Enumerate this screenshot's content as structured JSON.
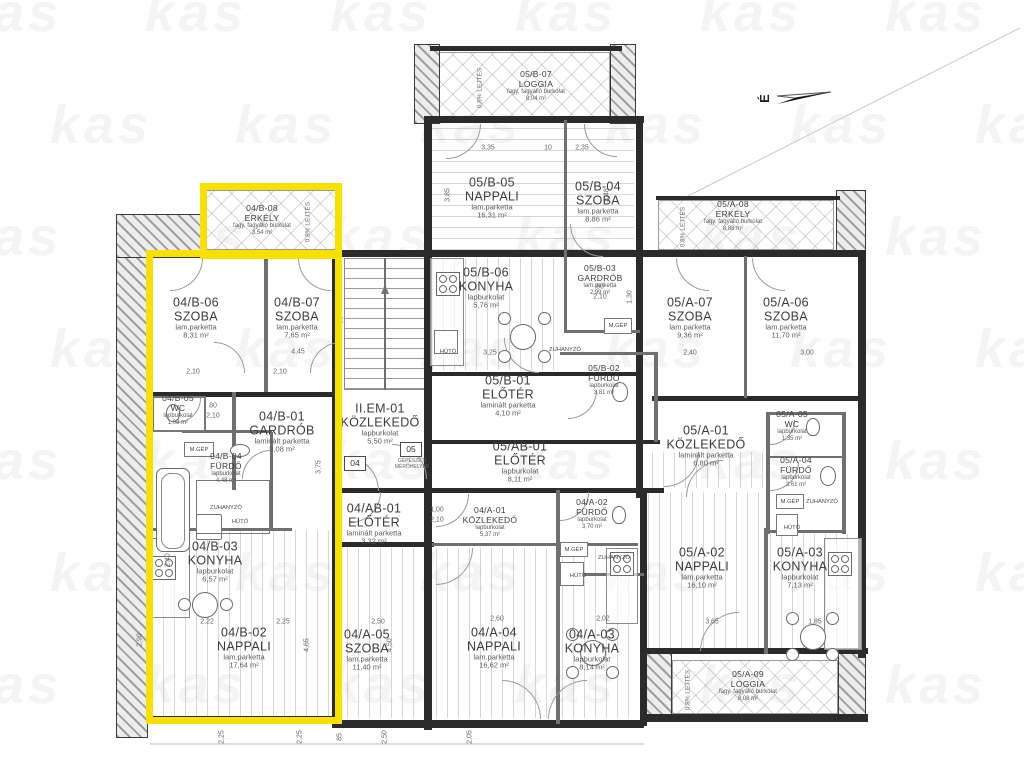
{
  "watermark": {
    "text": "kas"
  },
  "north": {
    "label": "É"
  },
  "markers": {
    "m04": "04",
    "m05": "05"
  },
  "note": {
    "l1": "GÉPÉSZETI",
    "l2": "MÉRŐHELYEK"
  },
  "slope": "0,8% LEJTÉS",
  "fixtures": {
    "huto": "HŰTŐ",
    "zuhanyzo": "ZUHANYZÓ",
    "mgep": "M.GÉP"
  },
  "colors": {
    "highlight": "#f8e100",
    "wall": "#2b2b2b"
  },
  "rooms": [
    {
      "id": "04/B-08",
      "name": "ERKÉLY",
      "material": "fagy. fagyálló burkolat",
      "area": "3,54 m²"
    },
    {
      "id": "04/B-06",
      "name": "SZOBA",
      "material": "lam.parketta",
      "area": "8,31 m²"
    },
    {
      "id": "04/B-07",
      "name": "SZOBA",
      "material": "lam.parketta",
      "area": "7,65 m²"
    },
    {
      "id": "04/B-05",
      "name": "WC",
      "material": "lapburkolat",
      "area": "1,08 m²"
    },
    {
      "id": "04/B-01",
      "name": "GARDRÓB",
      "material": "laminált parketta",
      "area": "9,08 m²"
    },
    {
      "id": "04/B-04",
      "name": "FÜRDŐ",
      "material": "lapburkolat",
      "area": "4,48 m²"
    },
    {
      "id": "04/B-03",
      "name": "KONYHA",
      "material": "lapburkolat",
      "area": "6,57 m²"
    },
    {
      "id": "04/B-02",
      "name": "NAPPALI",
      "material": "lam.parketta",
      "area": "17,64 m²"
    },
    {
      "id": "II.EM-01",
      "name": "KÖZLEKEDŐ",
      "material": "lapburkolat",
      "area": "5,50 m²"
    },
    {
      "id": "04/AB-01",
      "name": "ELŐTÉR",
      "material": "laminált parketta",
      "area": "3,32 m²"
    },
    {
      "id": "04/A-05",
      "name": "SZOBA",
      "material": "lam.parketta",
      "area": "11,40 m²"
    },
    {
      "id": "04/A-01",
      "name": "KÖZLEKEDŐ",
      "material": "lapburkolat",
      "area": "5,37 m²"
    },
    {
      "id": "04/A-02",
      "name": "FÜRDŐ",
      "material": "lapburkolat",
      "area": "3,70 m²"
    },
    {
      "id": "04/A-04",
      "name": "NAPPALI",
      "material": "lam.parketta",
      "area": "16,62 m²"
    },
    {
      "id": "04/A-03",
      "name": "KONYHA",
      "material": "lapburkolat",
      "area": "8,14 m²"
    },
    {
      "id": "05/B-07",
      "name": "LOGGIA",
      "material": "fagy. fagyálló burkolat",
      "area": "8,04 m²"
    },
    {
      "id": "05/B-05",
      "name": "NAPPALI",
      "material": "lam.parketta",
      "area": "16,31 m²"
    },
    {
      "id": "05/B-04",
      "name": "SZOBA",
      "material": "lam.parketta",
      "area": "8,86 m²"
    },
    {
      "id": "05/B-06",
      "name": "KONYHA",
      "material": "lapburkolat",
      "area": "5,76 m²"
    },
    {
      "id": "05/B-03",
      "name": "GARDRÓB",
      "material": "lam.parketta",
      "area": "2,99 m²"
    },
    {
      "id": "05/B-01",
      "name": "ELŐTÉR",
      "material": "laminált parketta",
      "area": "4,10 m²"
    },
    {
      "id": "05/B-02",
      "name": "FÜRDŐ",
      "material": "lapburkolat",
      "area": "3,81 m²"
    },
    {
      "id": "05/AB-01",
      "name": "ELŐTÉR",
      "material": "lapburkolat",
      "area": "8,11 m²"
    },
    {
      "id": "05/A-08",
      "name": "ERKÉLY",
      "material": "fagy. fagyálló burkolat",
      "area": "8,88 m²"
    },
    {
      "id": "05/A-07",
      "name": "SZOBA",
      "material": "lam.parketta",
      "area": "9,36 m²"
    },
    {
      "id": "05/A-06",
      "name": "SZOBA",
      "material": "lam.parketta",
      "area": "11,70 m²"
    },
    {
      "id": "05/A-01",
      "name": "KÖZLEKEDŐ",
      "material": "laminált parketta",
      "area": "6,80 m²"
    },
    {
      "id": "05/A-05",
      "name": "WC",
      "material": "lapburkolat",
      "area": "1,35 m²"
    },
    {
      "id": "05/A-04",
      "name": "FÜRDŐ",
      "material": "lapburkolat",
      "area": "3,61 m²"
    },
    {
      "id": "05/A-02",
      "name": "NAPPALI",
      "material": "lam.parketta",
      "area": "16,10 m²"
    },
    {
      "id": "05/A-03",
      "name": "KONYHA",
      "material": "lapburkolat",
      "area": "7,13 m²"
    },
    {
      "id": "05/A-09",
      "name": "LOGGIA",
      "material": "fagy. fagyálló burkolat",
      "area": "8,08 m²"
    }
  ],
  "dims": [
    "2,22",
    "2,25",
    "2,50",
    "2,60",
    "2,02",
    "3,65",
    "1,85",
    "4,45",
    "2,10",
    "2,10",
    "2,40",
    "3,00",
    "3,35",
    "10",
    "2,35",
    "2,25",
    "2,25",
    "2,50",
    "2,05",
    "85",
    "80",
    "2,10",
    "90",
    "1,00",
    "2,10",
    "80",
    "2,10",
    "3,25",
    "1,30",
    "3,85",
    "3,48",
    "4,50",
    "4,65",
    "3,75",
    "2,40",
    "2,90"
  ]
}
